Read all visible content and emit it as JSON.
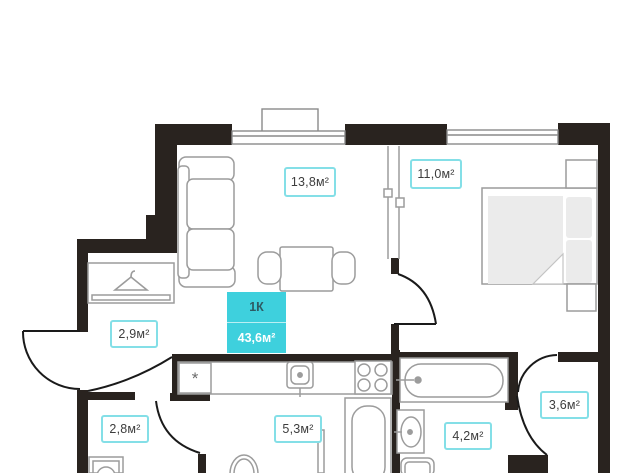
{
  "floorplan": {
    "badge": {
      "type_label": "1К",
      "total_area": "43,6м²"
    },
    "rooms": [
      {
        "id": "living-room",
        "area_label": "13,8м²"
      },
      {
        "id": "bedroom",
        "area_label": "11,0м²"
      },
      {
        "id": "hallway",
        "area_label": "2,9м²"
      },
      {
        "id": "storage",
        "area_label": "2,8м²"
      },
      {
        "id": "bathroom",
        "area_label": "5,3м²"
      },
      {
        "id": "second-bathroom",
        "area_label": "4,2м²"
      },
      {
        "id": "wardrobe",
        "area_label": "3,6м²"
      }
    ],
    "symbols": {
      "kitchen_unit": "*"
    },
    "colors": {
      "wall": "#29231f",
      "furniture_line": "#9c9c9c",
      "accent": "#3ed0dd",
      "label_border": "#84dfe7",
      "text": "#3d3d3d"
    }
  }
}
